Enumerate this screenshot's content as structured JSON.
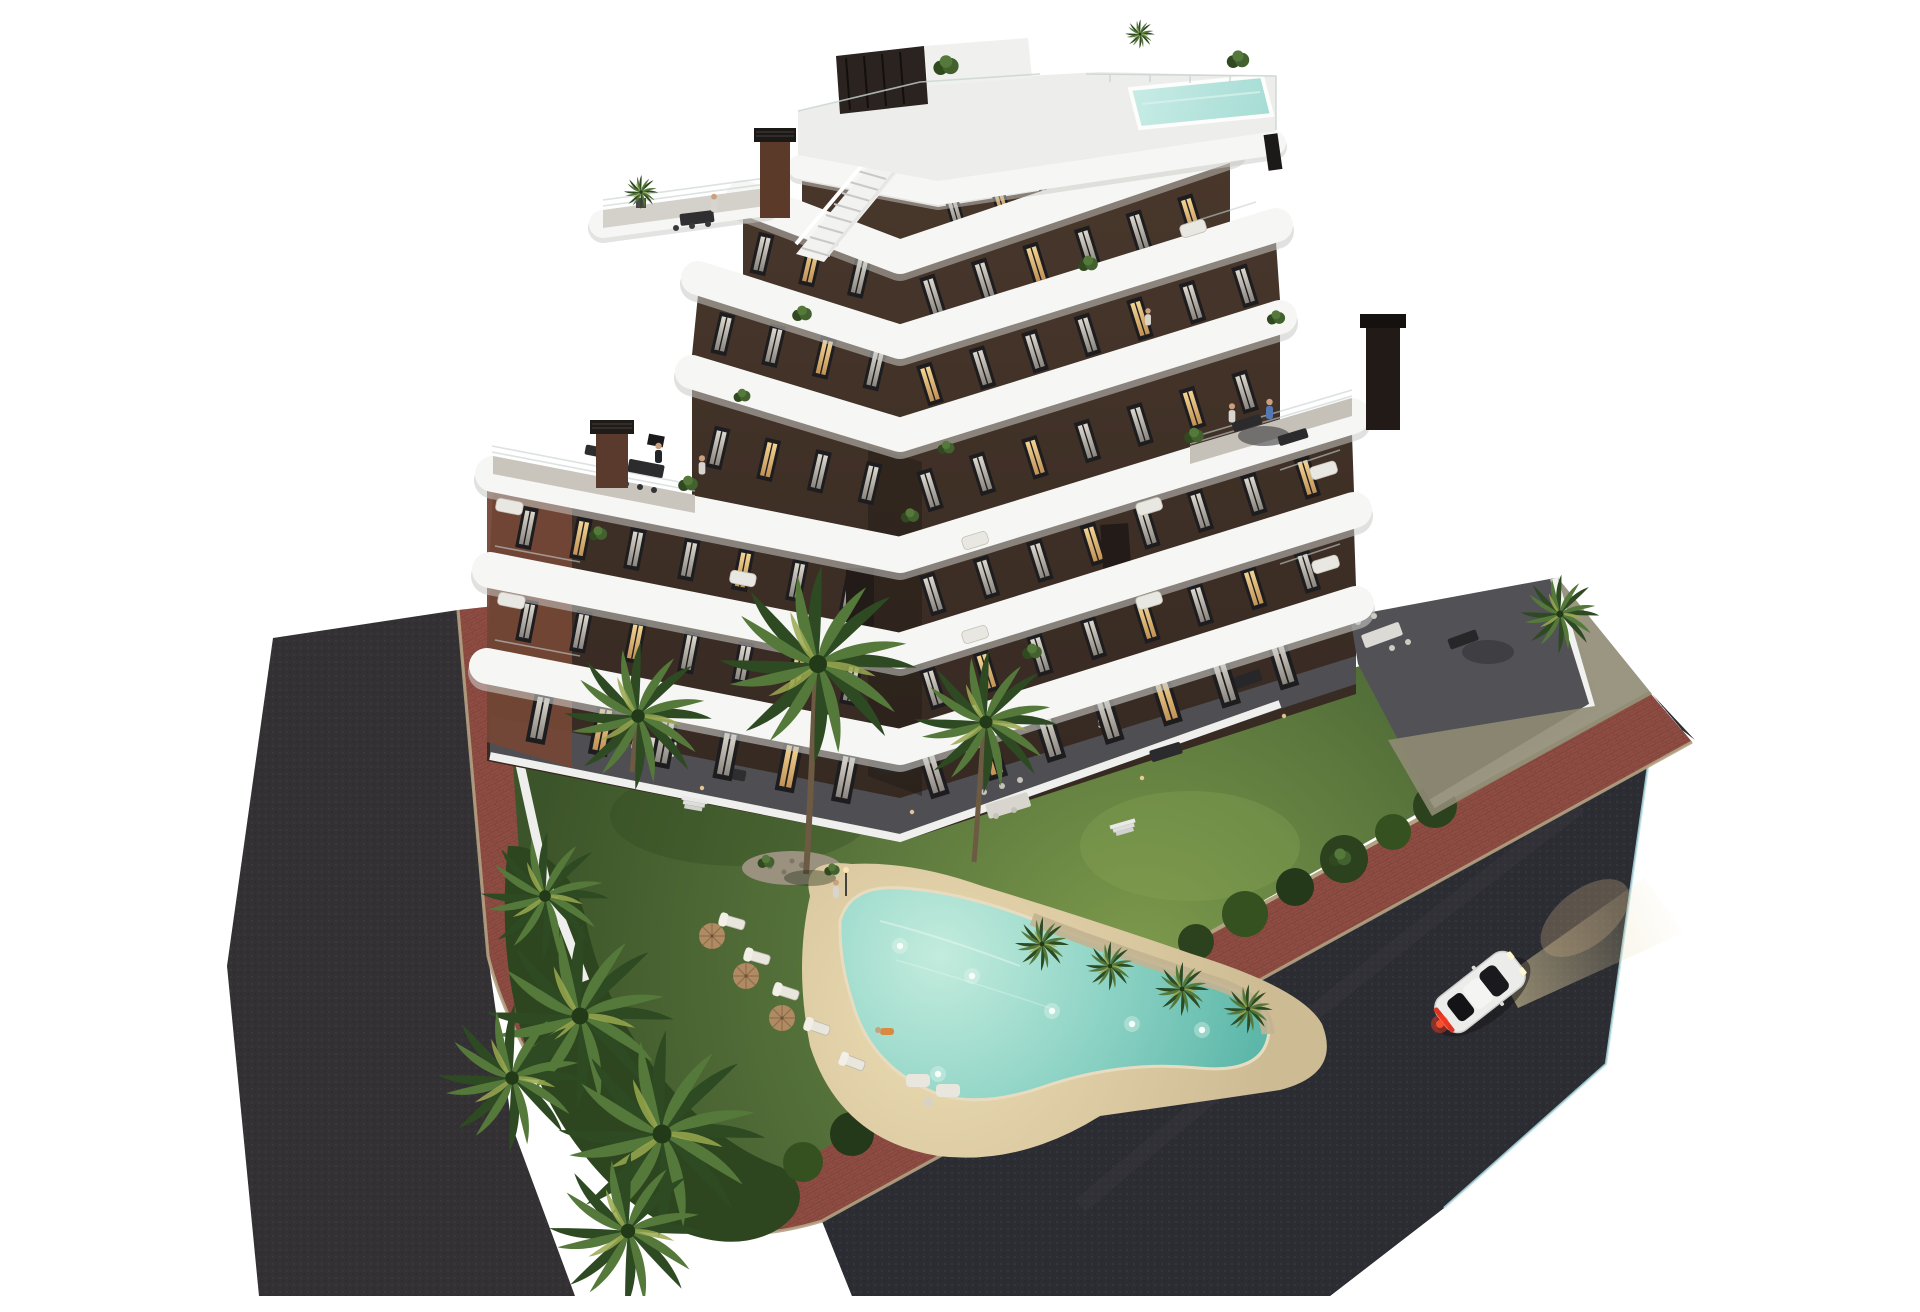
{
  "scene": {
    "type": "3d-architectural-render",
    "description": "Aerial dusk rendering of a modern 7-level apartment building with curved white wrap-around balconies and dark brown facades, on a corner plot with landscaped garden, free-form illuminated swimming pool, palm trees, red-brick sidewalk between two dark asphalt roads, and a white coupe driving with headlights on",
    "time_of_day": "dusk",
    "background": "#ffffff"
  },
  "building": {
    "levels_visible": 7,
    "wings": 2,
    "balcony_style": "continuous curved white slab bands",
    "facade_style": "dark chocolate brown with reddish brick side face",
    "rooftop": {
      "pool": true,
      "pergola": true,
      "external_stairs": true,
      "planters": true
    },
    "chimneys": 3,
    "setback_terraces": 4,
    "windows_lit_some": true,
    "people_on_terraces": true
  },
  "garden": {
    "lawn": true,
    "pool": {
      "shape": "freeform-boomerang",
      "underwater_lights": 6,
      "beach_deck": "sand colored"
    },
    "sun_loungers": 5,
    "parasols": 3,
    "rock_island": true,
    "palm_trees": 12,
    "hedge_border": true,
    "garden_lights": true,
    "ground_floor_terraces": "dark tile with dining sets and lounge furniture"
  },
  "roads": {
    "left_road": {
      "surface": "dark asphalt",
      "direction": "diagonal band on the left"
    },
    "right_road": {
      "surface": "dark asphalt",
      "edge_line": "pale blue curb line",
      "direction": "wide diagonal band lower right"
    },
    "sidewalk": {
      "material": "red brick pavers with tan curbs",
      "layout": "wraps the corner between both roads"
    }
  },
  "vehicles": [
    {
      "type": "coupe",
      "color": "white",
      "headlights_on": true,
      "taillights_on": true,
      "position": "right road, driving toward upper right"
    }
  ],
  "people_visible": 11,
  "palette": {
    "background": "#ffffff",
    "asphalt": "#343134",
    "asphalt_right": "#2c2d33",
    "sidewalk_brick": "#8e4c42",
    "curb_tan": "#b3a283",
    "lawn_light": "#7d9a4c",
    "lawn": "#55713a",
    "lawn_dark": "#3c5429",
    "hedge": "#2e461f",
    "palm_dark": "#2d4a22",
    "palm_light": "#55793a",
    "palm_accent": "#9aa94f",
    "sand_light": "#ecdcb2",
    "sand": "#cdbb94",
    "pool_light": "#c3ecdd",
    "pool_mid": "#8fd4c6",
    "pool_deep": "#5cb7a9",
    "rooftop_pool": "#a5dcd4",
    "slab_white": "#f6f6f4",
    "slab_shadow": "#c8c8c4",
    "facade_dark_top": "#4a382c",
    "facade_dark": "#342821",
    "facade_brick": "#744736",
    "window_frame": "#1d1c1f",
    "terrace_dark": "#4f4f53",
    "terrace_light": "#c9c5bd",
    "courtyard": "#a39a87",
    "car_body": "#ececea",
    "taillight": "#e03422",
    "headlight_glow": "#e8d6a2"
  }
}
